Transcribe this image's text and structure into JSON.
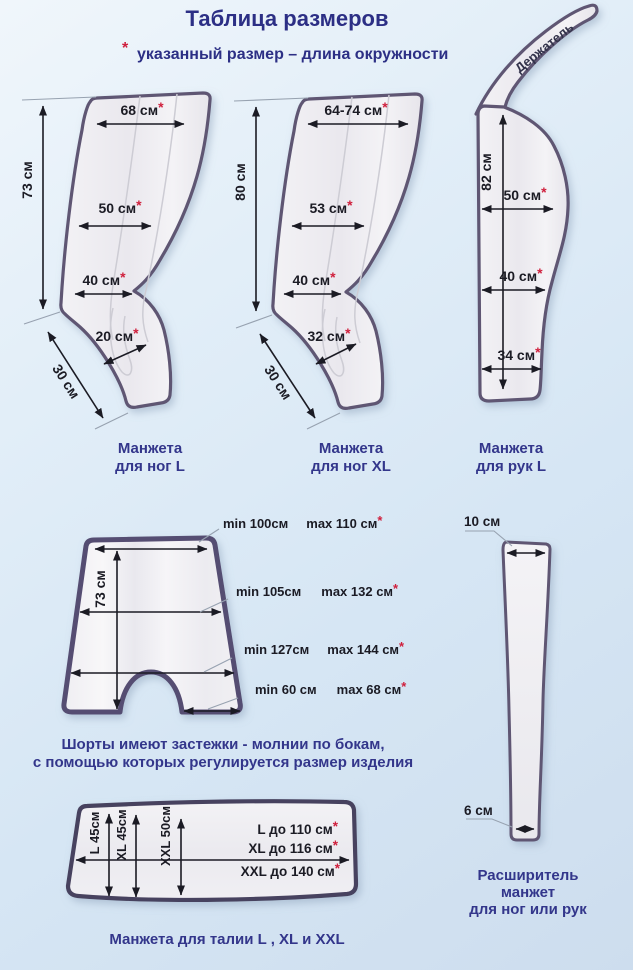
{
  "colors": {
    "navy": "#2c2f85",
    "red_asterisk": "#cf1f3c",
    "outline_purple": "#5e5673",
    "measure_text": "#1b1b24"
  },
  "header": {
    "title": "Таблица размеров",
    "asterisk": "*",
    "note": "указанный размер – длина окружности"
  },
  "leg_cuff_l": {
    "height": "73 см",
    "top_width": "68 см",
    "mid_width": "50 см",
    "lower_width": "40 см",
    "ankle_width": "20 см",
    "foot_length": "30 см",
    "caption_line1": "Манжета",
    "caption_line2": "для ног L"
  },
  "leg_cuff_xl": {
    "height": "80 см",
    "top_width": "64-74 см",
    "mid_width": "53 см",
    "lower_width": "40 см",
    "ankle_width": "32 см",
    "foot_length": "30 см",
    "caption_line1": "Манжета",
    "caption_line2": "для ног XL"
  },
  "arm_cuff": {
    "holder_label": "Держатель",
    "height": "82 см",
    "top_width": "50 см",
    "mid_width": "40 см",
    "bottom_width": "34 см",
    "caption_line1": "Манжета",
    "caption_line2": "для рук L"
  },
  "shorts": {
    "waist_min": "min 100см",
    "waist_max": "max 110 см",
    "height": "73 см",
    "hip_min": "min 105см",
    "hip_max": "max 132 см",
    "bottom_min": "min 127см",
    "bottom_max": "max 144 см",
    "leg_min": "min 60 см",
    "leg_max": "max 68 см",
    "note_line1": "Шорты имеют застежки - молнии по бокам,",
    "note_line2": "с помощью которых регулируется размер изделия"
  },
  "waist_cuff": {
    "l_height": "L 45см",
    "xl_height": "XL 45см",
    "xxl_height": "XXL 50см",
    "l_girth": "L до 110 см",
    "xl_girth": "XL до 116 см",
    "xxl_girth": "XXL до 140 см",
    "caption": "Манжета для талии  L , XL и XXL"
  },
  "extender": {
    "top_width": "10 см",
    "bottom_width": "6 см",
    "caption_line1": "Расширитель",
    "caption_line2": "манжет",
    "caption_line3": "для ног или рук"
  }
}
